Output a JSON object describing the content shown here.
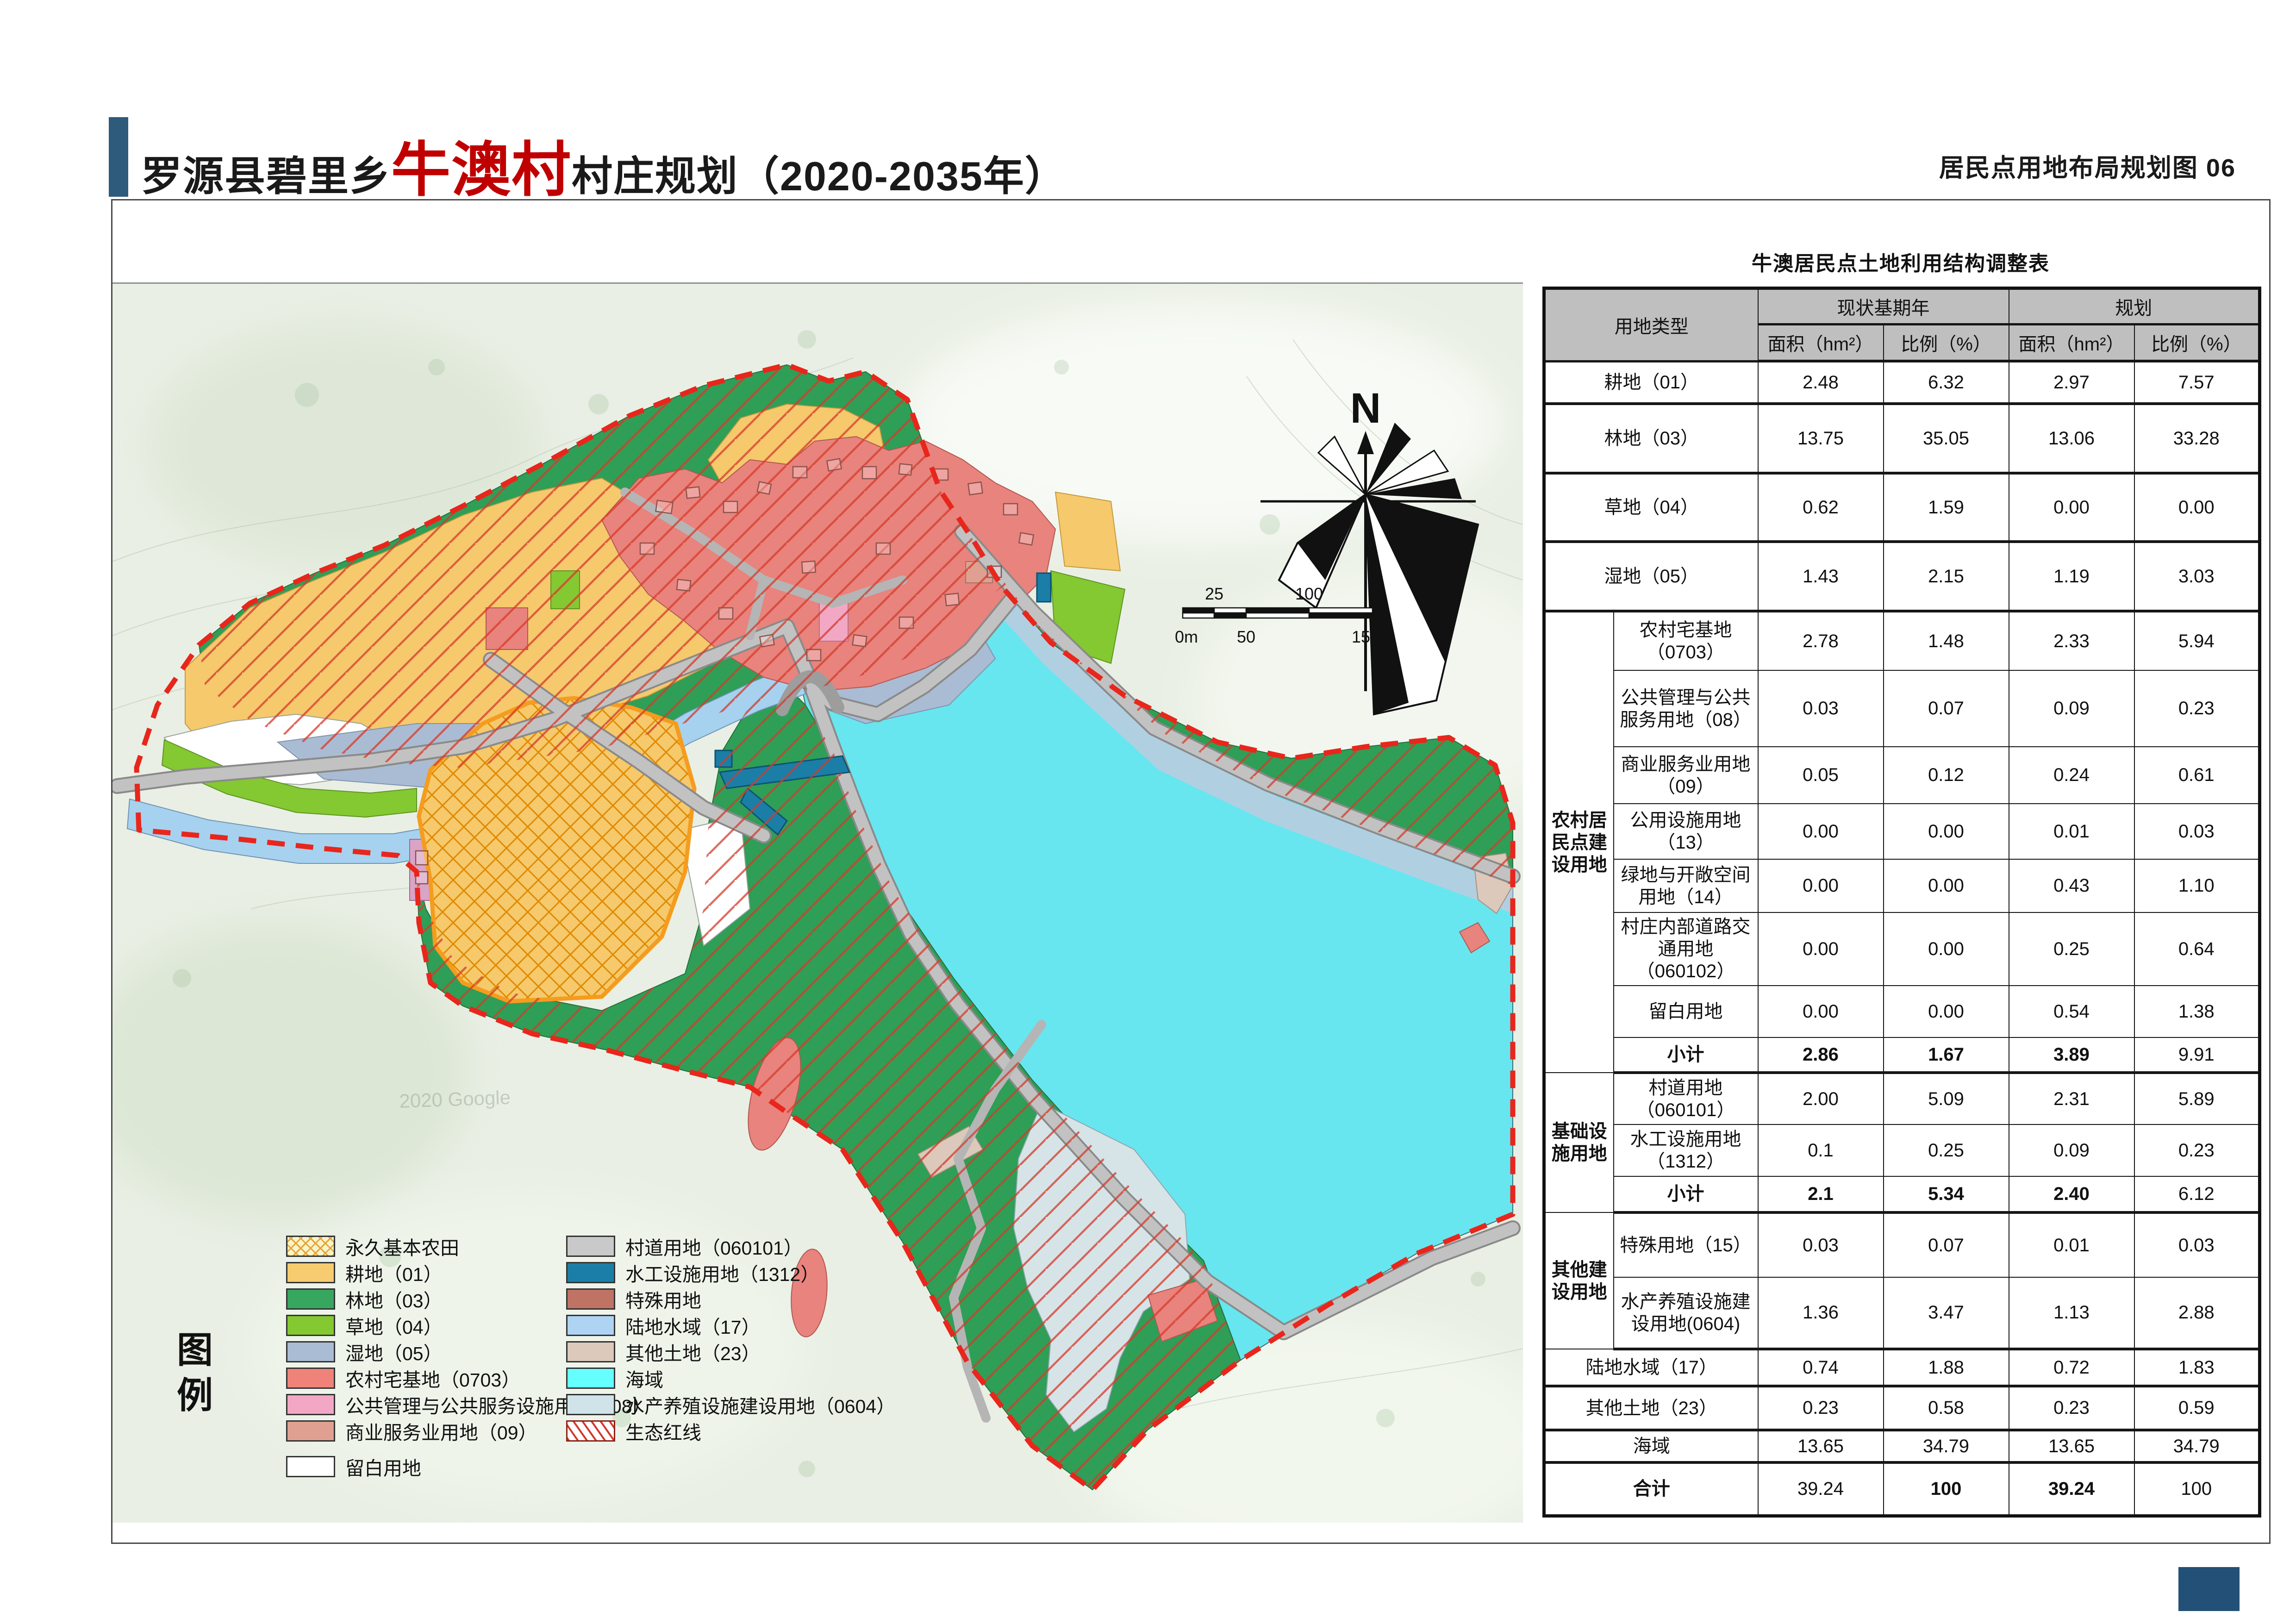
{
  "header": {
    "title_prefix": "罗源县碧里乡",
    "title_highlight": "牛澳村",
    "title_suffix": "村庄规划（2020-2035年）",
    "right_title": "居民点用地布局规划图 06"
  },
  "map": {
    "compass_label": "N",
    "watermark": "2020 Google",
    "scale_bar": {
      "top_ticks": [
        "25",
        "100"
      ],
      "bottom_ticks": [
        "0m",
        "50",
        "150m"
      ]
    }
  },
  "legend": {
    "title_chars": [
      "图",
      "例"
    ],
    "left": [
      {
        "label": "永久基本农田",
        "color": "#FBF3C6",
        "pattern": "goldhatch"
      },
      {
        "label": "耕地（01）",
        "color": "#F7CB6F"
      },
      {
        "label": "林地（03）",
        "color": "#37A75F"
      },
      {
        "label": "草地（04）",
        "color": "#84C832"
      },
      {
        "label": "湿地（05）",
        "color": "#A9BCD3"
      },
      {
        "label": "农村宅基地（0703）",
        "color": "#EF8379"
      },
      {
        "label": "公共管理与公共服务设施用地（08）",
        "color": "#F2A8C4"
      },
      {
        "label": "商业服务业用地（09）",
        "color": "#DFA091"
      },
      {
        "label": "留白用地",
        "color": "#FFFFFF"
      }
    ],
    "right": [
      {
        "label": "村道用地（060101）",
        "color": "#C9C9C9"
      },
      {
        "label": "水工设施用地（1312）",
        "color": "#1B7EA6"
      },
      {
        "label": "特殊用地",
        "color": "#BE7365"
      },
      {
        "label": "陆地水域（17）",
        "color": "#AFD3F2"
      },
      {
        "label": "其他土地（23）",
        "color": "#DCC9BB"
      },
      {
        "label": "海域",
        "color": "#66FFFF"
      },
      {
        "label": "水产养殖设施建设用地（0604）",
        "color": "#CFE3E9"
      },
      {
        "label": "生态红线",
        "color": "#FFFFFF",
        "pattern": "redhatch"
      }
    ]
  },
  "table": {
    "title": "牛澳居民点土地利用结构调整表",
    "header": {
      "type_col": "用地类型",
      "current": "现状基期年",
      "planned": "规划",
      "area": "面积（hm²）",
      "ratio": "比例（%）"
    },
    "rows": [
      {
        "label": "耕地（01）",
        "span2": true,
        "tb": true,
        "v": [
          "2.48",
          "6.32",
          "2.97",
          "7.57"
        ]
      },
      {
        "label": "林地（03）",
        "span2": true,
        "tb": true,
        "v": [
          "13.75",
          "35.05",
          "13.06",
          "33.28"
        ]
      },
      {
        "label": "草地（04）",
        "span2": true,
        "tb": true,
        "v": [
          "0.62",
          "1.59",
          "0.00",
          "0.00"
        ]
      },
      {
        "label": "湿地（05）",
        "span2": true,
        "tb": true,
        "v": [
          "1.43",
          "2.15",
          "1.19",
          "3.03"
        ]
      },
      {
        "g": "农村居民点建设用地",
        "gr": 8,
        "label": "农村宅基地（0703）",
        "v": [
          "2.78",
          "1.48",
          "2.33",
          "5.94"
        ]
      },
      {
        "label": "公共管理与公共服务用地（08）",
        "v": [
          "0.03",
          "0.07",
          "0.09",
          "0.23"
        ]
      },
      {
        "label": "商业服务业用地（09）",
        "v": [
          "0.05",
          "0.12",
          "0.24",
          "0.61"
        ]
      },
      {
        "label": "公用设施用地（13）",
        "v": [
          "0.00",
          "0.00",
          "0.01",
          "0.03"
        ]
      },
      {
        "label": "绿地与开敞空间用地（14）",
        "v": [
          "0.00",
          "0.00",
          "0.43",
          "1.10"
        ]
      },
      {
        "label": "村庄内部道路交通用地（060102）",
        "v": [
          "0.00",
          "0.00",
          "0.25",
          "0.64"
        ]
      },
      {
        "label": "留白用地",
        "v": [
          "0.00",
          "0.00",
          "0.54",
          "1.38"
        ]
      },
      {
        "label": "小计",
        "bl": true,
        "tb": true,
        "v": [
          "2.86",
          "1.67",
          "3.89",
          "9.91"
        ],
        "bv": [
          1,
          1,
          1,
          0
        ]
      },
      {
        "g": "基础设施用地",
        "gr": 3,
        "label": "村道用地（060101）",
        "v": [
          "2.00",
          "5.09",
          "2.31",
          "5.89"
        ]
      },
      {
        "label": "水工设施用地（1312）",
        "v": [
          "0.1",
          "0.25",
          "0.09",
          "0.23"
        ]
      },
      {
        "label": "小计",
        "bl": true,
        "tb": true,
        "v": [
          "2.1",
          "5.34",
          "2.40",
          "6.12"
        ],
        "bv": [
          1,
          1,
          1,
          0
        ]
      },
      {
        "g": "其他建设用地",
        "gr": 2,
        "label": "特殊用地（15）",
        "v": [
          "0.03",
          "0.07",
          "0.01",
          "0.03"
        ]
      },
      {
        "label": "水产养殖设施建设用地(0604)",
        "tb": true,
        "v": [
          "1.36",
          "3.47",
          "1.13",
          "2.88"
        ]
      },
      {
        "label": "陆地水域（17）",
        "span2": true,
        "tb": true,
        "v": [
          "0.74",
          "1.88",
          "0.72",
          "1.83"
        ]
      },
      {
        "label": "其他土地（23）",
        "span2": true,
        "tb": true,
        "v": [
          "0.23",
          "0.58",
          "0.23",
          "0.59"
        ]
      },
      {
        "label": "海域",
        "span2": true,
        "tb": true,
        "v": [
          "13.65",
          "34.79",
          "13.65",
          "34.79"
        ]
      },
      {
        "label": "合计",
        "span2": true,
        "bl": true,
        "v": [
          "39.24",
          "100",
          "39.24",
          "100"
        ],
        "bv": [
          0,
          1,
          1,
          0
        ]
      }
    ]
  },
  "colors": {
    "accent_bar": "#2E5A7C",
    "title_highlight": "#C00000",
    "footer_block": "#235077",
    "table_header_bg": "#BFBFBF",
    "boundary_red": "#E8261C",
    "farmland_border_orange": "#F59C1E",
    "forest_green": "#2F9E57",
    "sea_cyan": "#67E6F0",
    "field_yellow": "#F5C96C",
    "homestead_salmon": "#E8837D",
    "road_gray": "#BDBDBD",
    "hydraulic_teal": "#1B7EA6"
  }
}
